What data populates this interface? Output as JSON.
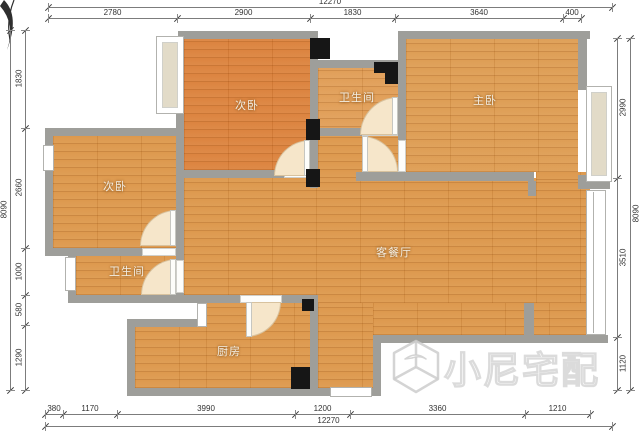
{
  "plan": {
    "type": "apartment-floor-plan"
  },
  "compass": {
    "icon": "north-arrow"
  },
  "rooms": {
    "bedroom_top": {
      "label": "次卧"
    },
    "bathroom_top": {
      "label": "卫生间"
    },
    "master_bedroom": {
      "label": "主卧"
    },
    "bedroom_left": {
      "label": "次卧"
    },
    "bathroom_left": {
      "label": "卫生间"
    },
    "living_dining": {
      "label": "客餐厅"
    },
    "kitchen": {
      "label": "厨房"
    }
  },
  "dimensions": {
    "top_total": "12270",
    "bottom_total": "12270",
    "left_total": "8090",
    "right_total": "8090",
    "top_segments": [
      "2780",
      "2900",
      "1830",
      "3640",
      "400"
    ],
    "left_segments": [
      "1830",
      "2660",
      "1000",
      "580",
      "1290"
    ],
    "right_segments": [
      "2990",
      "3510",
      "1120"
    ],
    "bottom_segments": [
      "380",
      "1170",
      "3990",
      "1200",
      "3360",
      "1210"
    ]
  },
  "watermark": {
    "text": "小尼宅配",
    "logo": "cube-logo"
  },
  "colors": {
    "wall": "#9e9e9a",
    "floor_main": "#dc9547",
    "floor_warm": "#db7f38",
    "floor_light": "#e09b52",
    "column": "#161616",
    "door_swing": "#f6e6ca",
    "dimension_text": "#333333",
    "background": "#ffffff"
  }
}
